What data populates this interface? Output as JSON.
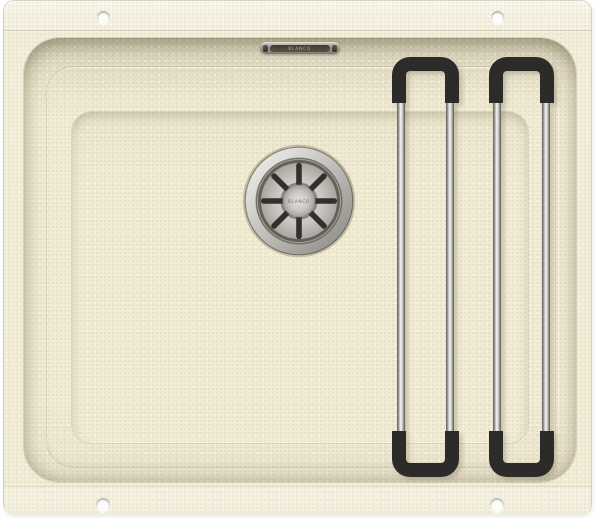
{
  "image_type": "product-photo",
  "subject": "undermount granite composite kitchen sink, top view, with two movable rails",
  "overflow": {
    "brand_text": "BLANCO"
  },
  "drain": {
    "cap_text": "BLANCO"
  },
  "parts": {
    "sink_body": "cream speckled granite sink body",
    "bowl": "single rectangular bowl with stepped ledge",
    "overflow_cover": "chrome overflow slot cover",
    "drain_strainer": "stainless steel strainer with 8 radial slots",
    "rails": "two U-shaped chrome rails with black grips",
    "mounting_holes": "four fixing holes in the flange"
  },
  "colors": {
    "background": "#ffffff",
    "body_cream": "#f1ecd6",
    "flange_cream": "#f7f4e5",
    "wall_shadow": "#cfc9b0",
    "rail_grip_black": "#2c2b29",
    "rail_rod_chrome": "#f4f4f2",
    "drain_steel": "#c7c6c2",
    "overflow_slot_dark": "#4a463e"
  }
}
